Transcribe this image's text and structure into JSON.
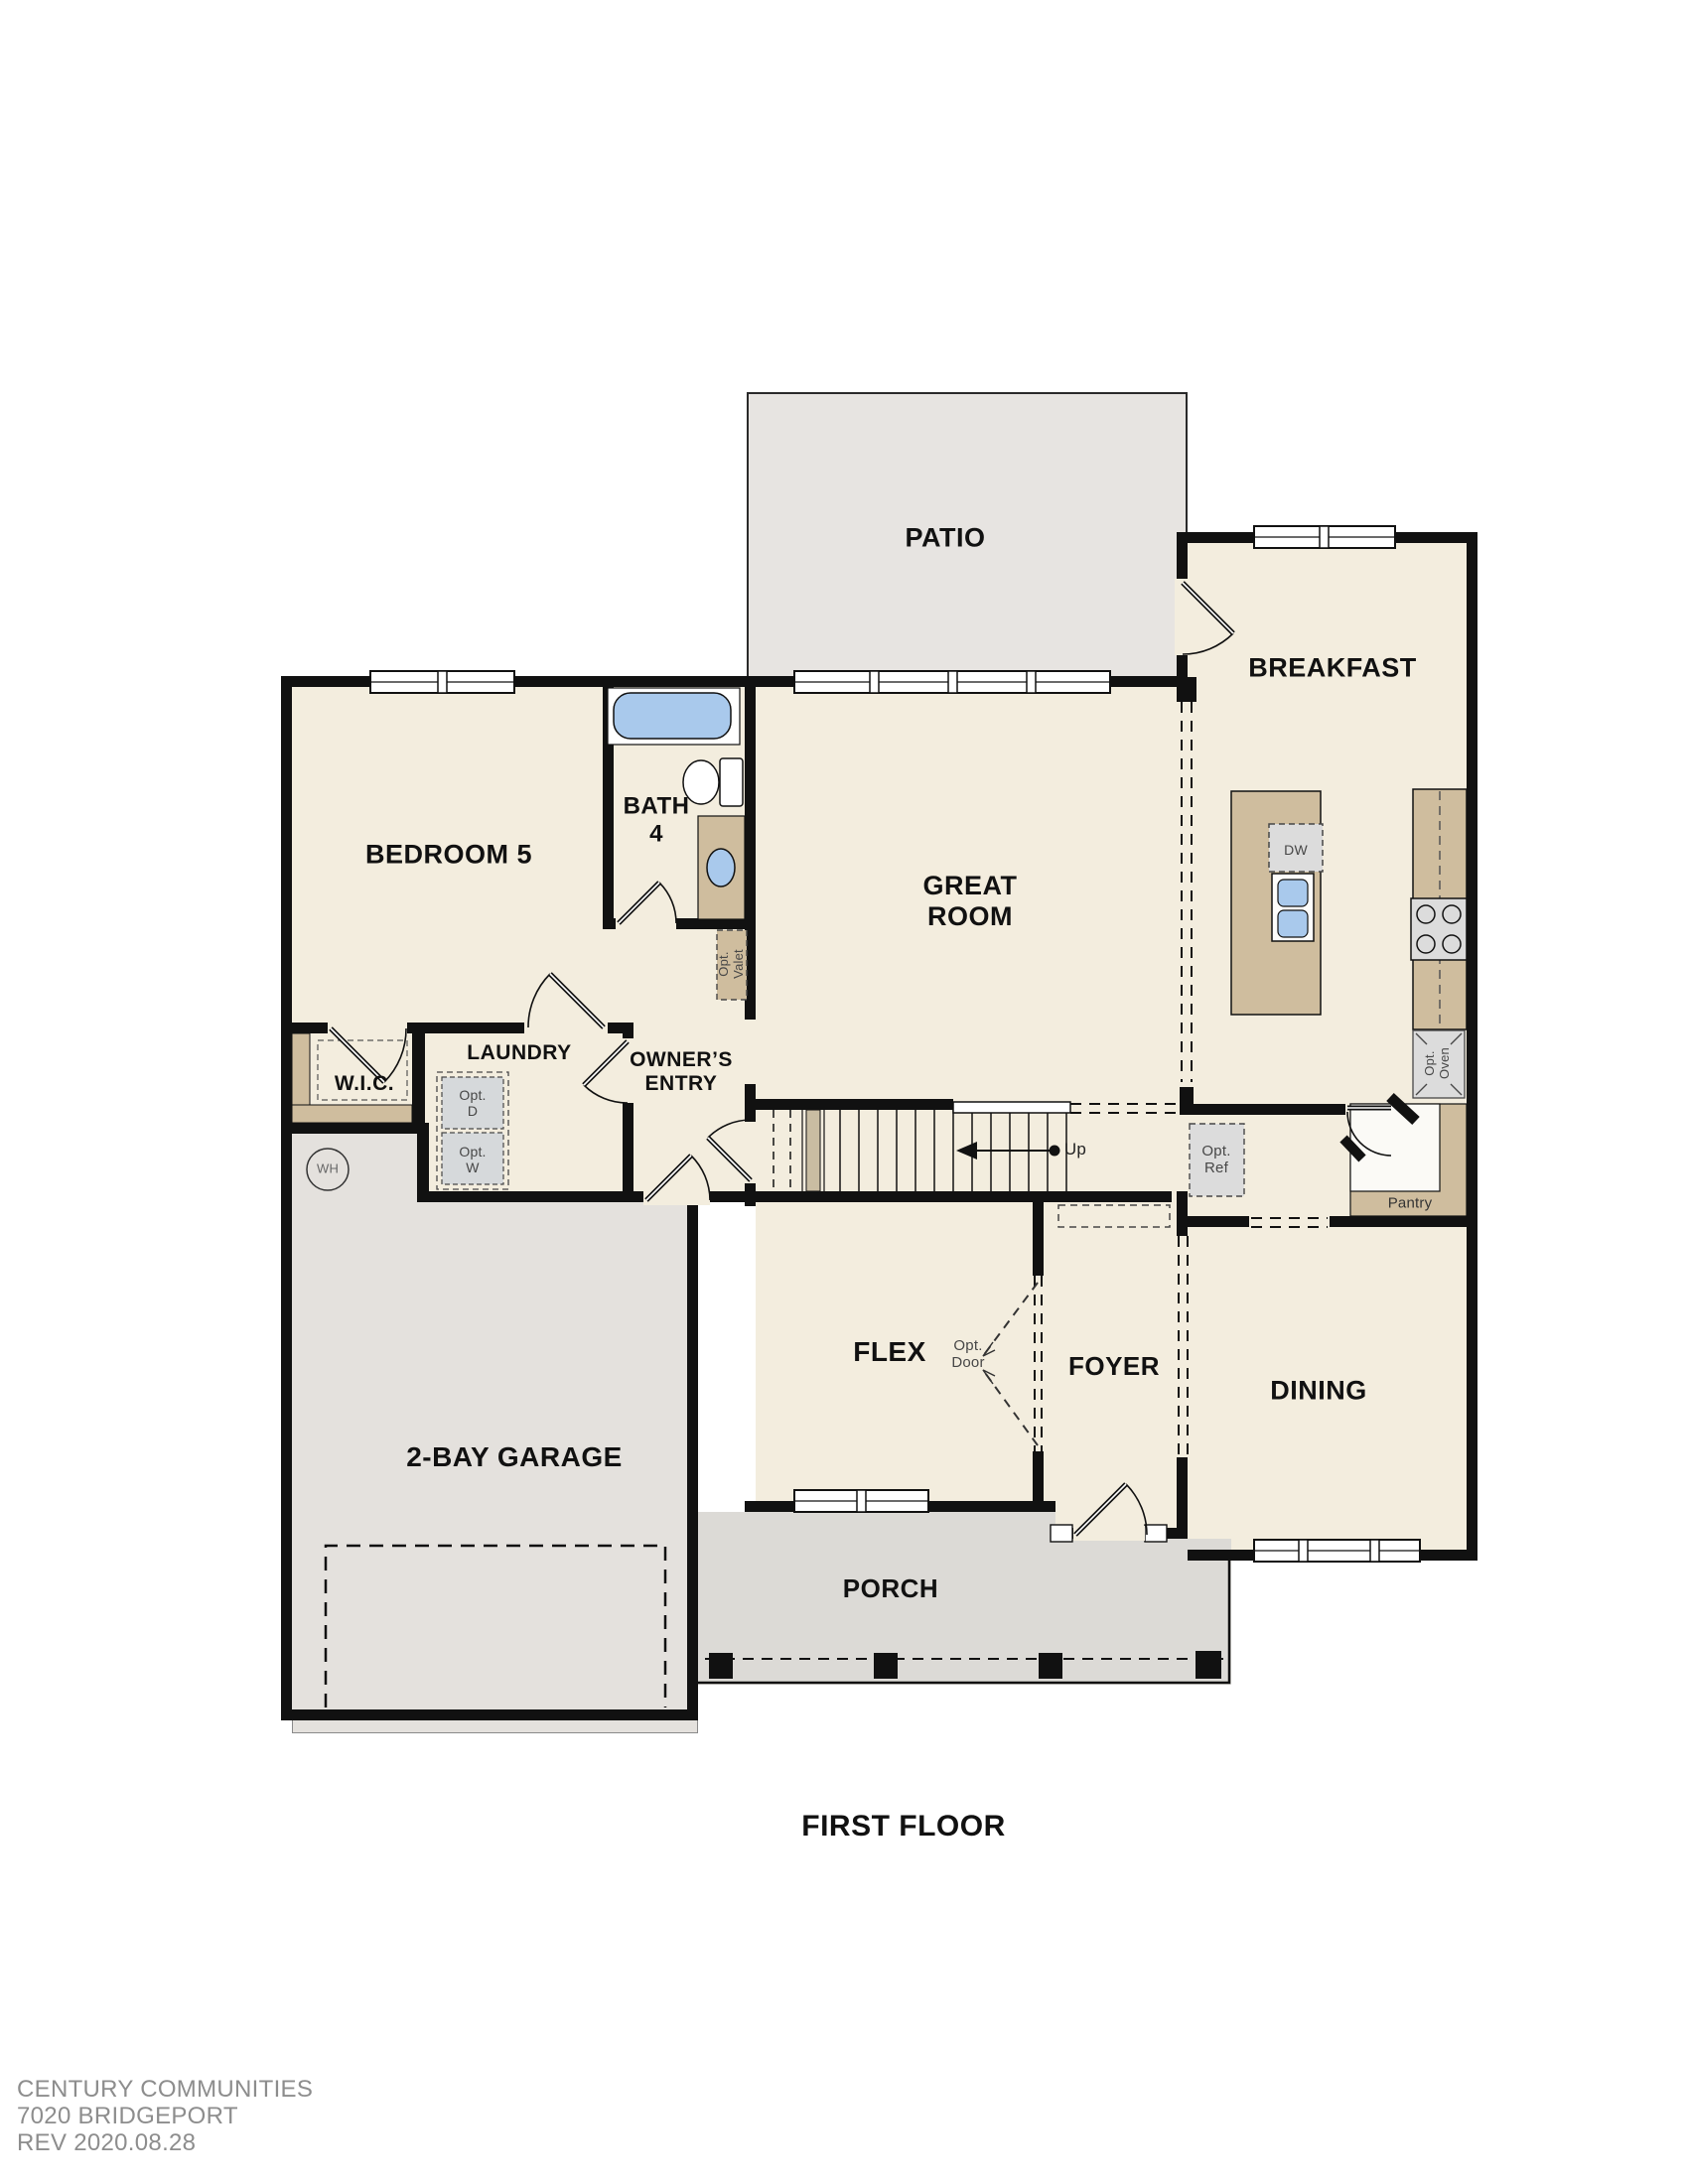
{
  "title": "FIRST FLOOR",
  "footer": {
    "line1": "CENTURY COMMUNITIES",
    "line2": "7020 BRIDGEPORT",
    "line3": "REV 2020.08.28"
  },
  "rooms": {
    "patio": "PATIO",
    "breakfast": "BREAKFAST",
    "bedroom5": "BEDROOM 5",
    "bath4": "BATH\n4",
    "great_room": "GREAT\nROOM",
    "wic": "W.I.C.",
    "laundry": "LAUNDRY",
    "owners_entry": "OWNER’S\nENTRY",
    "garage": "2-BAY GARAGE",
    "flex": "FLEX",
    "foyer": "FOYER",
    "dining": "DINING",
    "porch": "PORCH"
  },
  "annotations": {
    "up": "Up",
    "dw": "DW",
    "wh": "WH",
    "opt_d": "Opt.\nD",
    "opt_w": "Opt.\nW",
    "opt_ref": "Opt.\nRef",
    "opt_oven": "Opt.\nOven",
    "opt_valet": "Opt.\nValet",
    "opt_door": "Opt.\nDoor",
    "pantry": "Pantry"
  },
  "colors": {
    "wall": "#111111",
    "floor_cream": "#f3edde",
    "patio_gray": "#e7e4e1",
    "garage_gray": "#e4e1dd",
    "porch_gray": "#dcdad6",
    "counter_tan": "#cfbd9e",
    "appliance_gray": "#dcdcdc",
    "fixture_blue": "#a9c9ec"
  }
}
